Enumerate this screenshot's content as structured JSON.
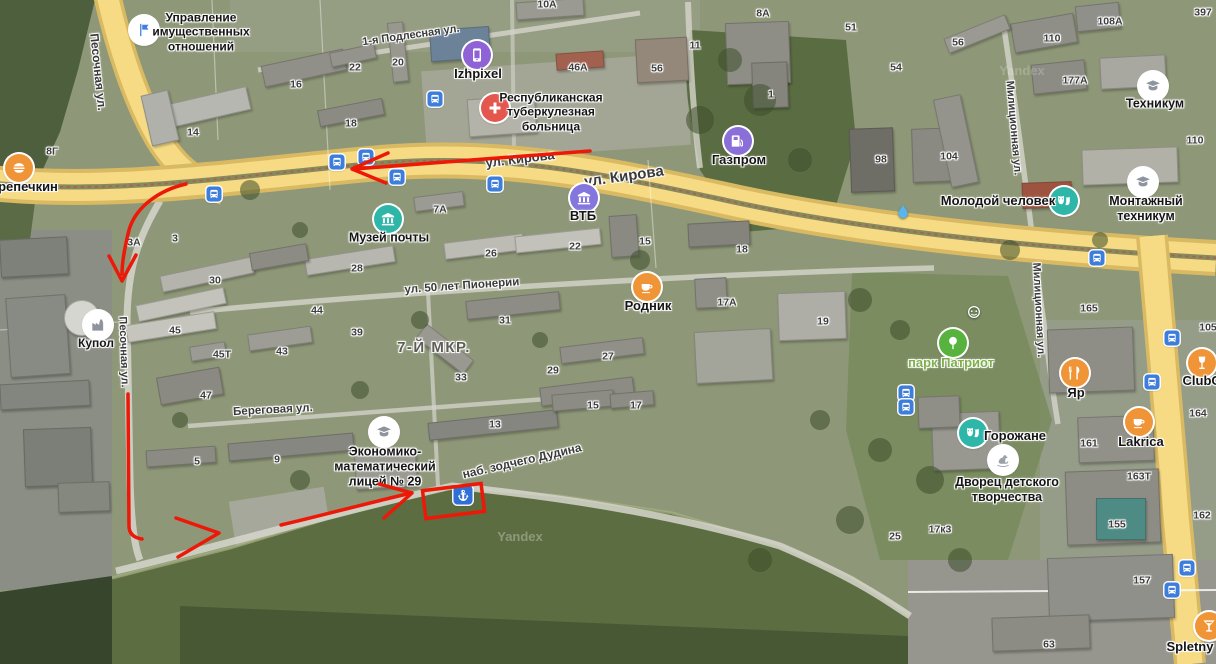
{
  "map": {
    "watermark": {
      "text": "Yandex",
      "positions": [
        {
          "x": 520,
          "y": 537,
          "o": 0.55
        },
        {
          "x": 1022,
          "y": 71,
          "o": 0.35
        }
      ]
    },
    "district_label": {
      "text": "7-Й МКР.",
      "x": 434,
      "y": 348
    },
    "streets": [
      {
        "label": "Песочная ул.",
        "x": 98,
        "y": 72,
        "rot": 84,
        "size": 12
      },
      {
        "label": "Песочная ул.",
        "x": 123,
        "y": 352,
        "rot": 88,
        "size": 11
      },
      {
        "label": "1-я Подлесная ул.",
        "x": 411,
        "y": 36,
        "rot": -8,
        "size": 11
      },
      {
        "label": "ул. Кирова",
        "x": 520,
        "y": 159,
        "rot": -7,
        "size": 13
      },
      {
        "label": "ул. Кирова",
        "x": 624,
        "y": 177,
        "rot": -8,
        "size": 15
      },
      {
        "label": "ул. 50 лет Пионерии",
        "x": 462,
        "y": 287,
        "rot": -4,
        "size": 11.5
      },
      {
        "label": "Береговая ул.",
        "x": 273,
        "y": 411,
        "rot": -3,
        "size": 11.5
      },
      {
        "label": "наб. зодчего Дудина",
        "x": 522,
        "y": 461,
        "rot": -13,
        "size": 12
      },
      {
        "label": "Милиционная ул.",
        "x": 1013,
        "y": 128,
        "rot": 85,
        "size": 11
      },
      {
        "label": "Милиционная ул.",
        "x": 1038,
        "y": 310,
        "rot": 87,
        "size": 11
      }
    ],
    "house_numbers": [
      {
        "t": "14",
        "x": 193,
        "y": 133
      },
      {
        "t": "16",
        "x": 296,
        "y": 85
      },
      {
        "t": "22",
        "x": 355,
        "y": 68
      },
      {
        "t": "20",
        "x": 398,
        "y": 63
      },
      {
        "t": "18",
        "x": 351,
        "y": 124
      },
      {
        "t": "8Г",
        "x": 52,
        "y": 152
      },
      {
        "t": "10А",
        "x": 547,
        "y": 5
      },
      {
        "t": "46А",
        "x": 578,
        "y": 68
      },
      {
        "t": "56",
        "x": 657,
        "y": 69
      },
      {
        "t": "11",
        "x": 695,
        "y": 46
      },
      {
        "t": "8А",
        "x": 763,
        "y": 14
      },
      {
        "t": "51",
        "x": 851,
        "y": 28
      },
      {
        "t": "54",
        "x": 896,
        "y": 68
      },
      {
        "t": "1",
        "x": 771,
        "y": 95
      },
      {
        "t": "98",
        "x": 881,
        "y": 160
      },
      {
        "t": "104",
        "x": 949,
        "y": 157
      },
      {
        "t": "56",
        "x": 958,
        "y": 43
      },
      {
        "t": "110",
        "x": 1052,
        "y": 39
      },
      {
        "t": "108А",
        "x": 1110,
        "y": 22
      },
      {
        "t": "397",
        "x": 1203,
        "y": 13
      },
      {
        "t": "177А",
        "x": 1075,
        "y": 81
      },
      {
        "t": "110",
        "x": 1195,
        "y": 141
      },
      {
        "t": "105",
        "x": 1208,
        "y": 328
      },
      {
        "t": "3А",
        "x": 134,
        "y": 243
      },
      {
        "t": "3",
        "x": 175,
        "y": 239
      },
      {
        "t": "30",
        "x": 215,
        "y": 281
      },
      {
        "t": "28",
        "x": 357,
        "y": 269
      },
      {
        "t": "26",
        "x": 491,
        "y": 254
      },
      {
        "t": "22",
        "x": 575,
        "y": 247
      },
      {
        "t": "15",
        "x": 645,
        "y": 242
      },
      {
        "t": "18",
        "x": 742,
        "y": 250
      },
      {
        "t": "7А",
        "x": 440,
        "y": 210
      },
      {
        "t": "17А",
        "x": 727,
        "y": 303
      },
      {
        "t": "19",
        "x": 823,
        "y": 322
      },
      {
        "t": "165",
        "x": 1089,
        "y": 309
      },
      {
        "t": "45",
        "x": 175,
        "y": 331
      },
      {
        "t": "45Т",
        "x": 222,
        "y": 355
      },
      {
        "t": "43",
        "x": 282,
        "y": 352
      },
      {
        "t": "47",
        "x": 206,
        "y": 396
      },
      {
        "t": "44",
        "x": 317,
        "y": 311
      },
      {
        "t": "39",
        "x": 357,
        "y": 333
      },
      {
        "t": "31",
        "x": 505,
        "y": 321
      },
      {
        "t": "33",
        "x": 461,
        "y": 378
      },
      {
        "t": "29",
        "x": 553,
        "y": 371
      },
      {
        "t": "27",
        "x": 608,
        "y": 357
      },
      {
        "t": "13",
        "x": 495,
        "y": 425
      },
      {
        "t": "15",
        "x": 593,
        "y": 406
      },
      {
        "t": "17",
        "x": 636,
        "y": 406
      },
      {
        "t": "5",
        "x": 197,
        "y": 462
      },
      {
        "t": "9",
        "x": 277,
        "y": 460
      },
      {
        "t": "25",
        "x": 895,
        "y": 537
      },
      {
        "t": "17к3",
        "x": 940,
        "y": 530
      },
      {
        "t": "161",
        "x": 1089,
        "y": 444
      },
      {
        "t": "163Т",
        "x": 1139,
        "y": 477
      },
      {
        "t": "164",
        "x": 1198,
        "y": 414
      },
      {
        "t": "162",
        "x": 1202,
        "y": 516
      },
      {
        "t": "155",
        "x": 1117,
        "y": 525
      },
      {
        "t": "157",
        "x": 1142,
        "y": 581
      },
      {
        "t": "63",
        "x": 1049,
        "y": 645
      }
    ],
    "pois": [
      {
        "id": "perepechkin",
        "icon": "burger",
        "bg": "#f09537",
        "fg": "#ffffff",
        "x": 19,
        "y": 168,
        "label": "репечкин",
        "lx": 28,
        "ly": 187
      },
      {
        "id": "property-office",
        "icon": "flag",
        "bg": "#ffffff",
        "fg": "#3f7fe0",
        "x": 144,
        "y": 30,
        "label": "Управление\nимущественных\nотношений",
        "lx": 201,
        "ly": 32,
        "ls": 12
      },
      {
        "id": "izhpixel",
        "icon": "phone",
        "bg": "#8f63d6",
        "fg": "#ffffff",
        "x": 477,
        "y": 55,
        "label": "Izhpixel",
        "lx": 478,
        "ly": 74
      },
      {
        "id": "tb-hospital",
        "icon": "cross",
        "bg": "#e4574e",
        "fg": "#ffffff",
        "x": 495,
        "y": 108,
        "label": "Республиканская\nтуберкулезная\nбольница",
        "lx": 551,
        "ly": 112,
        "ls": 12
      },
      {
        "id": "post-museum",
        "icon": "museum",
        "bg": "#2eb6a8",
        "fg": "#ffffff",
        "x": 388,
        "y": 219,
        "label": "Музей почты",
        "lx": 389,
        "ly": 238,
        "ls": 12.5
      },
      {
        "id": "vtb",
        "icon": "museum",
        "bg": "#8377de",
        "fg": "#ffffff",
        "x": 584,
        "y": 198,
        "label": "ВТБ",
        "lx": 583,
        "ly": 216
      },
      {
        "id": "gazprom",
        "icon": "fuel",
        "bg": "#8a6fd8",
        "fg": "#ffffff",
        "x": 738,
        "y": 141,
        "label": "Газпром",
        "lx": 739,
        "ly": 160
      },
      {
        "id": "rodnik",
        "icon": "cup",
        "bg": "#f09537",
        "fg": "#ffffff",
        "x": 647,
        "y": 287,
        "label": "Родник",
        "lx": 648,
        "ly": 306
      },
      {
        "id": "molodoy-chelovek",
        "icon": "masks",
        "bg": "#2eb6a8",
        "fg": "#ffffff",
        "x": 1064,
        "y": 201,
        "label": "Молодой человек",
        "lx": 998,
        "ly": 201
      },
      {
        "id": "tehnikum",
        "icon": "gradcap",
        "bg": "#ffffff",
        "fg": "#8e949e",
        "x": 1153,
        "y": 86,
        "label": "Техникум",
        "lx": 1155,
        "ly": 104,
        "ls": 12.5
      },
      {
        "id": "montazhny-tehnikum",
        "icon": "gradcap",
        "bg": "#ffffff",
        "fg": "#8e949e",
        "x": 1143,
        "y": 182,
        "label": "Монтажный\nтехникум",
        "lx": 1146,
        "ly": 209,
        "ls": 12.5
      },
      {
        "id": "park-patriot",
        "icon": "tree",
        "bg": "#58b23e",
        "fg": "#ffffff",
        "x": 953,
        "y": 343,
        "label": "парк Патриот",
        "lx": 951,
        "ly": 363,
        "lc": "#7db04a"
      },
      {
        "id": "yar",
        "icon": "restaurant",
        "bg": "#f09537",
        "fg": "#ffffff",
        "x": 1075,
        "y": 373,
        "label": "Яр",
        "lx": 1076,
        "ly": 393
      },
      {
        "id": "clubo",
        "icon": "wine",
        "bg": "#f09537",
        "fg": "#ffffff",
        "x": 1202,
        "y": 363,
        "label": "ClubO",
        "lx": 1202,
        "ly": 381
      },
      {
        "id": "lakrica",
        "icon": "cup",
        "bg": "#f09537",
        "fg": "#ffffff",
        "x": 1139,
        "y": 422,
        "label": "Lakrica",
        "lx": 1141,
        "ly": 442
      },
      {
        "id": "gorozhane",
        "icon": "masks",
        "bg": "#2eb6a8",
        "fg": "#ffffff",
        "x": 973,
        "y": 433,
        "label": "Горожане",
        "lx": 1015,
        "ly": 436
      },
      {
        "id": "dvorets-detskogo",
        "icon": "horse",
        "bg": "#ffffff",
        "fg": "#9aa0a8",
        "x": 1003,
        "y": 460,
        "label": "Дворец детского\nтворчества",
        "lx": 1007,
        "ly": 490,
        "ls": 12.5
      },
      {
        "id": "lyceum-29",
        "icon": "gradcap",
        "bg": "#ffffff",
        "fg": "#8e949e",
        "x": 384,
        "y": 432,
        "label": "Экономико-\nматематический\nлицей № 29",
        "lx": 385,
        "ly": 467,
        "ls": 12.5
      },
      {
        "id": "kupol",
        "icon": "factory",
        "bg": "#ffffff",
        "fg": "#8e949e",
        "x": 98,
        "y": 325,
        "label": "Купол",
        "lx": 96,
        "ly": 343,
        "ls": 12
      },
      {
        "id": "spletny",
        "icon": "cocktail",
        "bg": "#f09537",
        "fg": "#ffffff",
        "x": 1209,
        "y": 626,
        "label": "Spletny",
        "lx": 1190,
        "ly": 647
      },
      {
        "id": "fountain",
        "icon": "droplet",
        "shape": "plain",
        "fg": "#59b5ef",
        "x": 903,
        "y": 212,
        "label": ""
      },
      {
        "id": "park-attraction",
        "icon": "smiley",
        "shape": "plain",
        "fg": "#ffffff",
        "x": 974,
        "y": 312,
        "label": ""
      }
    ],
    "transit_stops": [
      {
        "x": 214,
        "y": 194
      },
      {
        "x": 337,
        "y": 162
      },
      {
        "x": 366,
        "y": 157
      },
      {
        "x": 397,
        "y": 177
      },
      {
        "x": 495,
        "y": 184
      },
      {
        "x": 435,
        "y": 99
      },
      {
        "x": 1097,
        "y": 258
      },
      {
        "x": 1172,
        "y": 338
      },
      {
        "x": 1152,
        "y": 382
      },
      {
        "x": 906,
        "y": 393
      },
      {
        "x": 906,
        "y": 407
      },
      {
        "x": 1187,
        "y": 568
      },
      {
        "x": 1172,
        "y": 590
      }
    ],
    "pier": {
      "x": 463,
      "y": 495
    },
    "annotations": {
      "color": "#ed1807",
      "stroke_width": 3.5,
      "paths": [
        "M590 151 L354 169",
        "M388 153 L352 169 L386 183",
        "M186 184 C160 190 136 206 129 230 C124 250 122 262 122 274",
        "M109 256 L122 281 L136 255",
        "M128 394 L129 526 Q129 537 142 539",
        "M176 518 L219 533 L178 557",
        "M281 525 C320 516 360 505 407 494",
        "M379 484 L412 493 L384 518"
      ],
      "rectangle": {
        "x": 424,
        "y": 487,
        "w": 59,
        "h": 28,
        "rot": -7
      }
    }
  }
}
